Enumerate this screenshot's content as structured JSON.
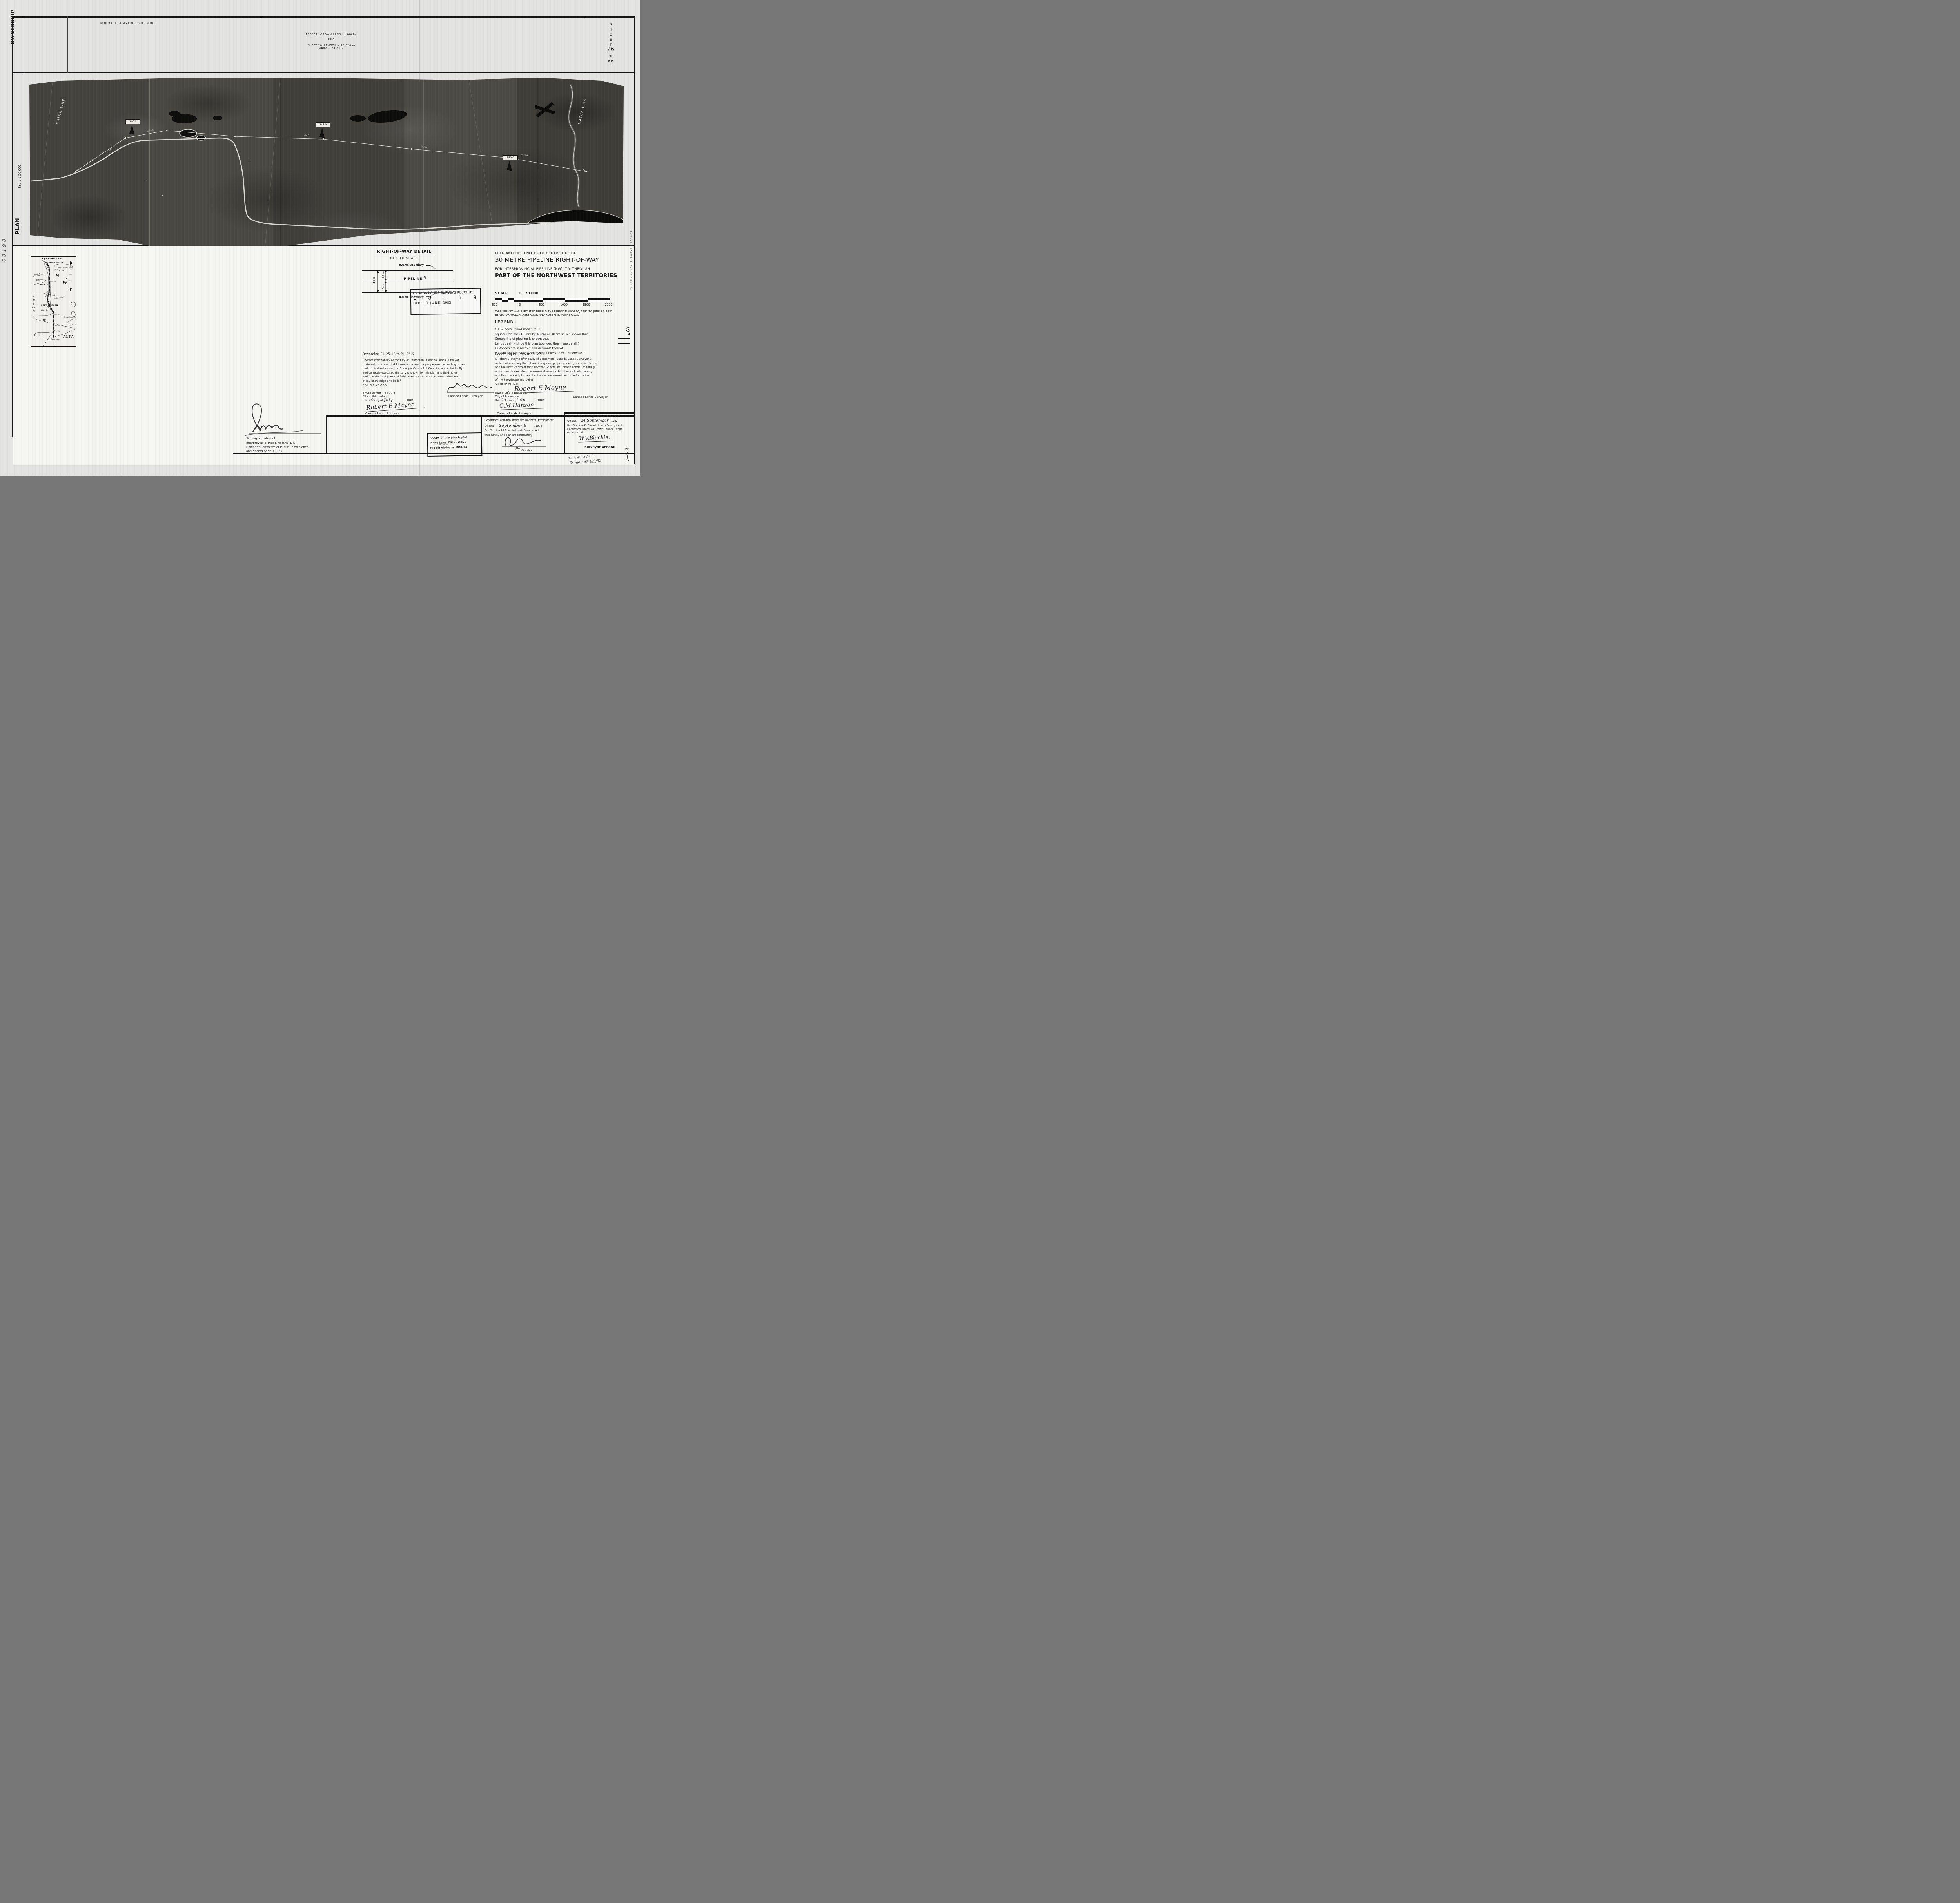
{
  "sheet": {
    "ownership_label": "OWNERSHIP",
    "mineral_claims": "MINERAL CLAIMS CROSSED - NONE",
    "federal_crown_land": "FEDERAL CROWN LAND - 1544 ha",
    "parcel_number": "002",
    "length_line": "SHEET 26: LENGTH = 13 820 m",
    "area_line": "AREA = 41.5 ha",
    "sheet_word": "SHEET",
    "sheet_number": "26",
    "of_word": "of",
    "sheet_total": "55"
  },
  "plan": {
    "plan_label": "PLAN",
    "scale_label": "Scale 1:20,000"
  },
  "photo": {
    "match_line_left": "MATCH LINE",
    "match_line_right": "MATCH LINE",
    "markers": {
      "0": "340.0",
      "1": "345.0",
      "2": "350.0"
    },
    "annotations": {
      "0": "PI 25-18",
      "1": "12543",
      "2": "104°43'",
      "3": "754.8",
      "4": "61°08'",
      "5": "PI 26-6"
    }
  },
  "key_plan": {
    "title": "KEY PLAN n.t.s.",
    "norman_wells": "NORMAN WELLS",
    "great_bear": "Great Bear Lake",
    "keele": "Keele R.",
    "redstone": "Redstone R.",
    "wrigley": "WRIGLEY",
    "mackenzie": "Mackenzie",
    "willowlake": "Willowlake R.",
    "fort_simpson": "FORT SIMPSON",
    "liard": "Liard R.",
    "great_slave": "Great Slave L.",
    "zama": "Zama Lake",
    "yukon": "YUKON",
    "letter_n": "N",
    "letter_w": "W",
    "letter_t": "T",
    "bc": "B C",
    "alta": "ALTA",
    "sixty": "60°",
    "ticks": {
      "0": "1",
      "1": "10",
      "2": "20",
      "3": "30",
      "4": "40",
      "5": "50",
      "6": "55"
    }
  },
  "row_detail": {
    "title": "RIGHT-OF-WAY DETAIL",
    "subtitle": "NOT TO SCALE",
    "row_boundary_top": "R.O.W. Boundary",
    "row_boundary_bottom": "R.O.W. Boundary",
    "pipeline_label": "PIPELINE",
    "dim_15_top": "15 m",
    "dim_15_bottom": "15 m",
    "dim_30": "30m"
  },
  "clsr_stamp": {
    "title": "CANADA LANDS SURVEYS RECORDS",
    "digits": {
      "0": "6",
      "1": "8",
      "2": "1",
      "3": "9",
      "4": "8"
    },
    "date_label": "DATE",
    "date_day": "18",
    "date_month": "JUNE",
    "date_year": "1982"
  },
  "title_block": {
    "line1": "PLAN AND FIELD NOTES OF CENTRE LINE OF",
    "line2": "30 METRE PIPELINE RIGHT-OF-WAY",
    "line3": "FOR INTERPROVINCIAL PIPE LINE (NW) LTD. THROUGH",
    "line4": "PART OF THE NORTHWEST TERRITORIES"
  },
  "scale_block": {
    "label": "SCALE",
    "ratio": "1 : 20 000",
    "ticks": {
      "0": "500",
      "1": "0",
      "2": "500",
      "3": "1000",
      "4": "1500",
      "5": "2000"
    },
    "note1": "THIS SURVEY WAS EXECUTED DURING THE PERIOD MARCH 10, 1981 TO JUNE 30, 1982",
    "note2": "BY VICTOR WOLCHANSKY C.L.S. AND ROBERT E. MAYNE C.L.S."
  },
  "legend": {
    "heading": "LEGEND :",
    "items": {
      "0": {
        "text": "C.L.S. posts found shown thus"
      },
      "1": {
        "text": "Square Iron bars 13 mm by 45 cm or 30 cm spikes shown thus"
      },
      "2": {
        "text": "Centre line of pipeline is shown thus"
      },
      "3": {
        "text": "Lands dealt with by this plan bounded thus ( see detail )"
      },
      "4": {
        "text": "Distances are in metres and decimals thereof ."
      },
      "5": {
        "text": "Pipeline right-of-way is 30 m wide unless shown otherwise ."
      }
    }
  },
  "affidavits": {
    "left": {
      "heading": "Regarding P.I. 25-18 to P.I. 26-6",
      "lines": {
        "0": "I, Victor Wolchansky of the City of Edmonton , Canada Lands Surveyor ,",
        "1": "make oath and say that I have in my own proper person , according to law",
        "2": "and the instructions of the Surveyor General of Canada Lands , faithfully",
        "3": "and correctly executed the survey shown by this plan and field notes ,",
        "4": "and that the said plan and field notes are correct and true to the best",
        "5": "of my knowledge and belief",
        "6": "SO HELP ME GOD ."
      }
    },
    "right": {
      "heading": "Regarding P.I. 26-6 to P.I. 27-1",
      "lines": {
        "0": "I, Robert E. Mayne of the City of Edmonton , Canada Lands Surveyor ,",
        "1": "make oath and say that I have in my own proper person , according to law",
        "2": "and the instructions of the Surveyor General of Canada Lands , faithfully",
        "3": "and correctly executed the survey shown by this plan and field notes ,",
        "4": "and that the said plan and field notes are correct and true to the best",
        "5": "of my knowledge and belief",
        "6": "SO HELP ME GOD ."
      }
    }
  },
  "sworn": {
    "left": {
      "l1": "Sworn before me at the",
      "l2": "City of Edmonton",
      "pre": "this",
      "day": "19",
      "mid": "day of",
      "month": "July",
      "year": ", 1982",
      "commissioner_signature": "Robert E Mayne",
      "commissioner_label": "Canada Lands Surveyor",
      "deponent_label": "Canada Lands Surveyor"
    },
    "right": {
      "l1": "Sworn before me at the",
      "l2": "City of Edmonton",
      "pre": "this",
      "day": "20",
      "mid": "day of",
      "month": "July",
      "year": ", 1982",
      "commissioner_signature": "C.M.Hanson",
      "commissioner_label": "Canada Lands Surveyor",
      "deponent_signature": "Robert E Mayne",
      "deponent_label": "Canada Lands Surveyor"
    }
  },
  "signing_block": {
    "line1": "Signing on behalf of",
    "line2": "Interprovincial Pipe Line (NW) LTD.",
    "line3": "Holder of Certificate of Public Convenience",
    "line4": "and Necessity No. OC-35"
  },
  "filed_stamp": {
    "l1a": "A Copy of this plan is",
    "l1b": "filed",
    "l2a": "in the",
    "l2b": "Land Titles",
    "l2c": "Office",
    "l3": "at Yellowknife as 1559-26"
  },
  "dept_indian": {
    "name": "Department of Indian Affairs and Northern Development",
    "city": "Ottawa",
    "date_hand": "September 9",
    "year": ", 1982",
    "re": "Re : Section 43 Canada Lands Surveys Act",
    "note": "This survey and plan are satisfactory",
    "for_word": "for",
    "title": "Minister"
  },
  "dept_energy": {
    "name": "Department of Energy Mines and Resources",
    "city": "Ottawa",
    "date_hand": "24 September",
    "year": ", 1982",
    "re": "Re : Section 43 Canada Lands Surveys Act",
    "note1": "Confirmed insofar as Crown Canada Lands",
    "note2": "are affected .",
    "signature": "W.V.Blackie.",
    "title": "Surveyor General"
  },
  "margin_notes": {
    "left_edge_hand": "68198",
    "right_edge_stamp": "CANADA LANDS SURVEYS RECORDS",
    "item_line": "Item #1-82 PL",
    "exmd_line": "Ex'md : AB 9/9/82",
    "ok": "ok"
  }
}
